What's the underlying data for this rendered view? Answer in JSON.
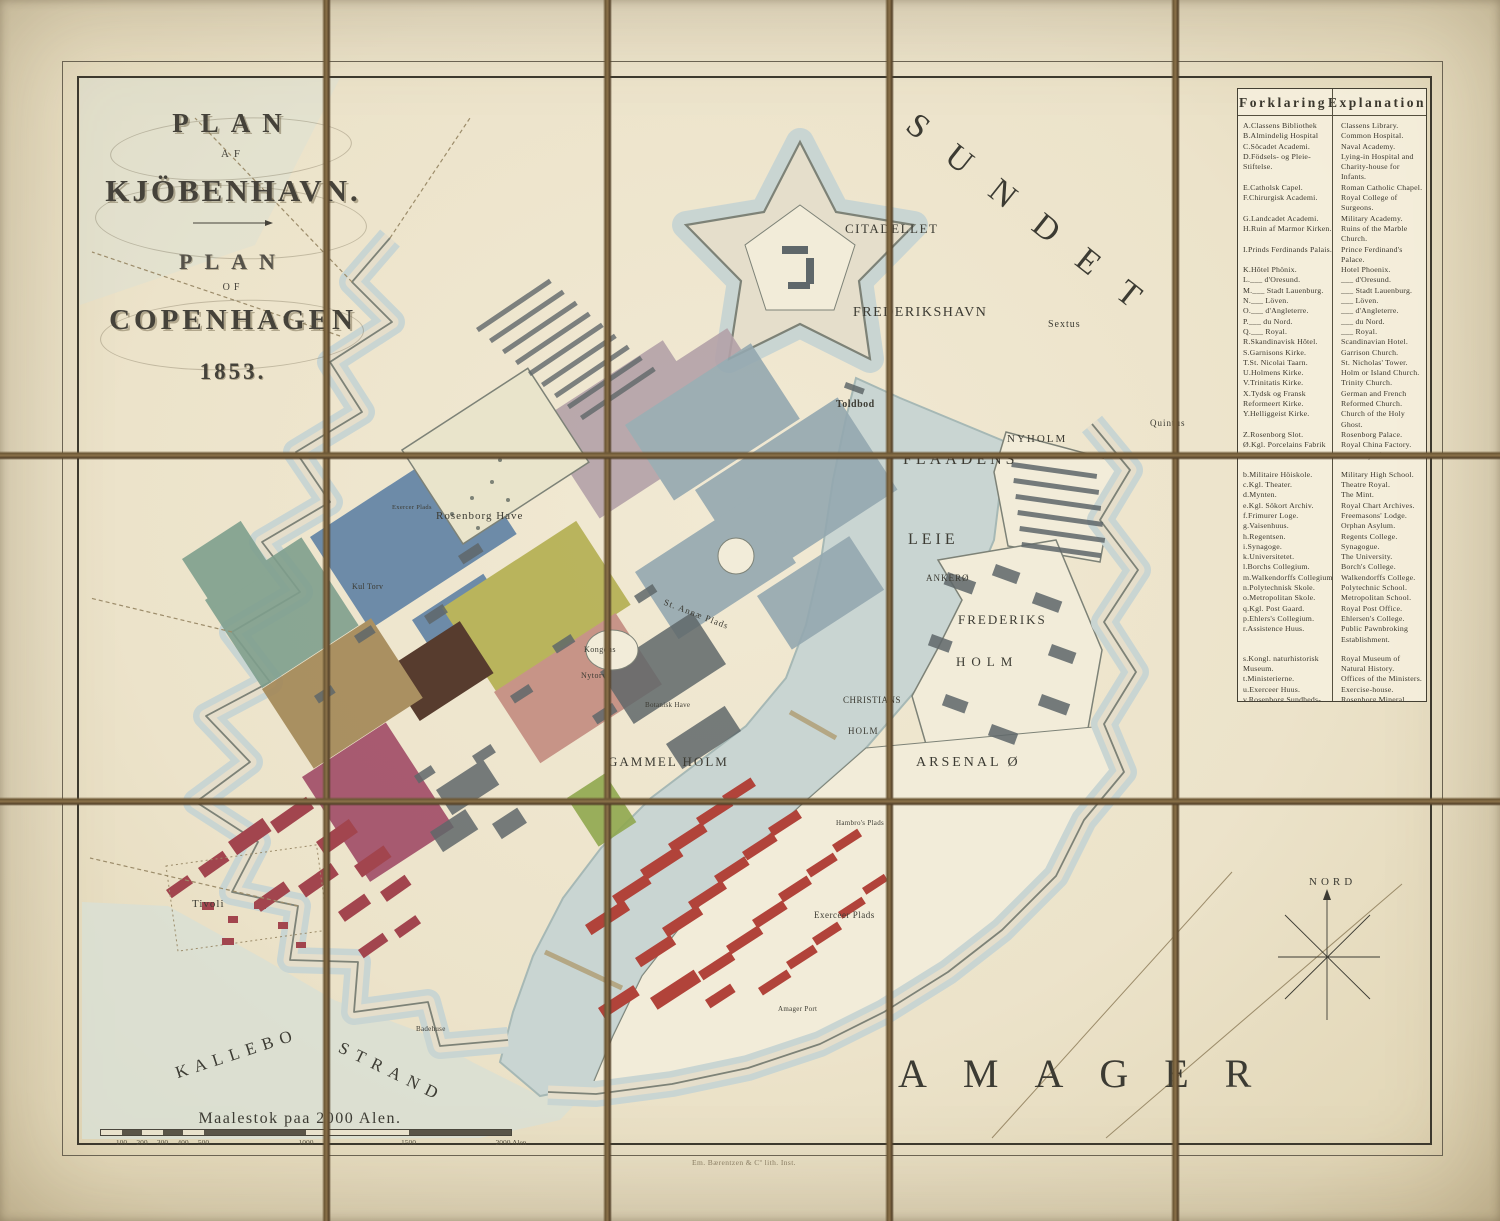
{
  "title_block": {
    "line1": "PLAN",
    "line2": "AF",
    "line3": "KJÖBENHAVN.",
    "line4": "PLAN",
    "line5": "OF",
    "line6": "COPENHAGEN",
    "year": "1853."
  },
  "legend": {
    "header_da": "Forklaring",
    "header_en": "Explanation",
    "entries": [
      {
        "da": "A.Classens Bibliothek",
        "en": "Classens Library."
      },
      {
        "da": "B.Almindelig Hospital",
        "en": "Common Hospital."
      },
      {
        "da": "C.Söcadet Academi.",
        "en": "Naval Academy."
      },
      {
        "da": "D.Födsels- og Pleie- Stiftelse.",
        "en": "Lying-in Hospital and Charity-house for Infants."
      },
      {
        "da": "E.Catholsk Capel.",
        "en": "Roman Catholic Chapel."
      },
      {
        "da": "F.Chirurgisk Academi.",
        "en": "Royal College of Surgeons."
      },
      {
        "da": "G.Landcadet Academi.",
        "en": "Military Academy."
      },
      {
        "da": "H.Ruin af Marmor Kirken.",
        "en": "Ruins of the Marble Church."
      },
      {
        "da": "I.Prinds Ferdinands Palais.",
        "en": "Prince Ferdinand's Palace."
      },
      {
        "da": "K.Hôtel Phönix.",
        "en": "Hotel Phoenix."
      },
      {
        "da": "L.___ d'Oresund.",
        "en": "___ d'Oresund."
      },
      {
        "da": "M.___ Stadt Lauenburg.",
        "en": "___ Stadt Lauenburg."
      },
      {
        "da": "N.___ Löven.",
        "en": "___ Löven."
      },
      {
        "da": "O.___ d'Angleterre.",
        "en": "___ d'Angleterre."
      },
      {
        "da": "P.___ du Nord.",
        "en": "___ du Nord."
      },
      {
        "da": "Q.___ Royal.",
        "en": "___ Royal."
      },
      {
        "da": "R.Skandinavisk Hôtel.",
        "en": "Scandinavian Hotel."
      },
      {
        "da": "S.Garnisons Kirke.",
        "en": "Garrison Church."
      },
      {
        "da": "T.St. Nicolai Taarn.",
        "en": "St. Nicholas' Tower."
      },
      {
        "da": "U.Holmens Kirke.",
        "en": "Holm or Island Church."
      },
      {
        "da": "V.Trinitatis Kirke.",
        "en": "Trinity Church."
      },
      {
        "da": "X.Tydsk og Fransk Reformeert Kirke.",
        "en": "German and French Reformed Church."
      },
      {
        "da": "Y.Helliggeist Kirke.",
        "en": "Church of the Holy Ghost."
      },
      {
        "da": "Z.Rosenborg Slot.",
        "en": "Rosenborg Palace."
      },
      {
        "da": "Ø.Kgl. Porcelains Fabrik",
        "en": "Royal China Factory."
      },
      {
        "da": "a.Kunst Academi.",
        "en": "Academy of Arts."
      },
      {
        "da": "b.Militaire Höiskole.",
        "en": "Military High School.",
        "gap": true
      },
      {
        "da": "c.Kgl. Theater.",
        "en": "Theatre Royal."
      },
      {
        "da": "d.Mynten.",
        "en": "The Mint."
      },
      {
        "da": "e.Kgl. Sökort Archiv.",
        "en": "Royal Chart Archives."
      },
      {
        "da": "f.Frimurer Loge.",
        "en": "Freemasons' Lodge."
      },
      {
        "da": "g.Vaisenhuus.",
        "en": "Orphan Asylum."
      },
      {
        "da": "h.Regentsen.",
        "en": "Regents College."
      },
      {
        "da": "i.Synagoge.",
        "en": "Synagogue."
      },
      {
        "da": "k.Universitetet.",
        "en": "The University."
      },
      {
        "da": "l.Borchs Collegium.",
        "en": "Borch's College."
      },
      {
        "da": "m.Walkendorffs Collegium",
        "en": "Walkendorffs College."
      },
      {
        "da": "n.Polytechnisk Skole.",
        "en": "Polytechnic School."
      },
      {
        "da": "o.Metropolitan Skole.",
        "en": "Metropolitan School."
      },
      {
        "da": "q.Kgl. Post Gaard.",
        "en": "Royal Post Office."
      },
      {
        "da": "p.Ehlers's Collegium.",
        "en": "Ehlersen's College."
      },
      {
        "da": "r.Assistence Huus.",
        "en": "Public Pawnbroking Establishment."
      },
      {
        "da": "s.Kongl. naturhistorisk Museum.",
        "en": "Royal Museum of Natural History.",
        "gap": true
      },
      {
        "da": "t.Ministerierne.",
        "en": "Offices of the Ministers."
      },
      {
        "da": "u.Exerceer Huus.",
        "en": "Exercise-house."
      },
      {
        "da": "v.Rosenborg Sundheds- brönd Anstalt.",
        "en": "Rosenborg Mineral Water Establishment."
      }
    ]
  },
  "map_labels": [
    {
      "id": "sundet",
      "text": "SUNDET",
      "x": 922,
      "y": 106,
      "size": 34,
      "ls": 31,
      "rot": 38.5
    },
    {
      "id": "citadellet",
      "text": "CITADELLET",
      "x": 845,
      "y": 221,
      "size": 13,
      "ls": 1.5
    },
    {
      "id": "frederikshavn",
      "text": "FREDERIKSHAVN",
      "x": 853,
      "y": 305,
      "size": 14,
      "ls": 1.5
    },
    {
      "id": "sextus",
      "text": "Sextus",
      "x": 1048,
      "y": 319,
      "size": 10,
      "ls": 1
    },
    {
      "id": "quintus",
      "text": "Quintus",
      "x": 1150,
      "y": 418,
      "size": 9,
      "ls": 1
    },
    {
      "id": "toldbod",
      "text": "Toldbod",
      "x": 836,
      "y": 399,
      "size": 10,
      "ls": 0.5,
      "bold": true
    },
    {
      "id": "nyholm",
      "text": "NYHOLM",
      "x": 1007,
      "y": 433,
      "size": 11,
      "ls": 2
    },
    {
      "id": "flaadens",
      "text": "FLAADENS",
      "x": 903,
      "y": 451,
      "size": 16,
      "ls": 4
    },
    {
      "id": "leie",
      "text": "LEIE",
      "x": 908,
      "y": 531,
      "size": 16,
      "ls": 4
    },
    {
      "id": "ankero",
      "text": "ANKERØ",
      "x": 926,
      "y": 573,
      "size": 9,
      "ls": 1
    },
    {
      "id": "frederiks",
      "text": "FREDERIKS",
      "x": 958,
      "y": 612,
      "size": 13,
      "ls": 2
    },
    {
      "id": "holm-frederiksholm",
      "text": "HOLM",
      "x": 956,
      "y": 654,
      "size": 13,
      "ls": 6
    },
    {
      "id": "christians",
      "text": "CHRISTIANS",
      "x": 843,
      "y": 695,
      "size": 9,
      "ls": 0.5
    },
    {
      "id": "holm-christiansholm",
      "text": "HOLM",
      "x": 848,
      "y": 726,
      "size": 9,
      "ls": 1
    },
    {
      "id": "gammel-holm",
      "text": "GAMMEL HOLM",
      "x": 608,
      "y": 754,
      "size": 13,
      "ls": 2
    },
    {
      "id": "arsenal-o",
      "text": "ARSENAL Ø",
      "x": 916,
      "y": 755,
      "size": 14,
      "ls": 3
    },
    {
      "id": "amager",
      "text": "AMAGER",
      "x": 898,
      "y": 1050,
      "size": 40,
      "ls": 36
    },
    {
      "id": "kallebo",
      "text": "KALLEBO",
      "x": 173,
      "y": 1064,
      "size": 17,
      "ls": 7,
      "rot": -18
    },
    {
      "id": "strand",
      "text": "STRAND",
      "x": 344,
      "y": 1038,
      "size": 17,
      "ls": 8,
      "rot": 26
    },
    {
      "id": "nord",
      "text": "NORD",
      "x": 1309,
      "y": 876,
      "size": 11,
      "ls": 4
    },
    {
      "id": "rosenborg-have",
      "text": "Rosenborg Have",
      "x": 436,
      "y": 510,
      "size": 11,
      "ls": 1
    },
    {
      "id": "exercer-plads-rosenborg",
      "text": "Exercer Plads",
      "x": 392,
      "y": 504,
      "size": 6.5,
      "ls": 0.3
    },
    {
      "id": "kul-torv",
      "text": "Kul Torv",
      "x": 352,
      "y": 582,
      "size": 8,
      "ls": 0.3
    },
    {
      "id": "tivoli",
      "text": "Tivoli",
      "x": 192,
      "y": 898,
      "size": 11,
      "ls": 1
    },
    {
      "id": "exerceer-plads",
      "text": "Exerceer Plads",
      "x": 814,
      "y": 910,
      "size": 9,
      "ls": 0.5
    },
    {
      "id": "hambros-plads",
      "text": "Hambro's Plads",
      "x": 836,
      "y": 819,
      "size": 7,
      "ls": 0.3
    },
    {
      "id": "botanisk-have",
      "text": "Botanisk Have",
      "x": 645,
      "y": 701,
      "size": 7,
      "ls": 0.3
    },
    {
      "id": "kongens",
      "text": "Kongens",
      "x": 584,
      "y": 645,
      "size": 8,
      "ls": 0.5
    },
    {
      "id": "nytorv",
      "text": "Nytorv",
      "x": 581,
      "y": 671,
      "size": 8,
      "ls": 0.5
    },
    {
      "id": "st-annae-plads",
      "text": "St. Annæ Plads",
      "x": 666,
      "y": 597,
      "size": 9,
      "ls": 1,
      "rot": 21
    },
    {
      "id": "badehuse",
      "text": "Badehuse",
      "x": 416,
      "y": 1025,
      "size": 7,
      "ls": 0.3
    },
    {
      "id": "amager-port",
      "text": "Amager Port",
      "x": 778,
      "y": 1005,
      "size": 7,
      "ls": 0.3
    }
  ],
  "scale": {
    "title": "Maalestok paa 2000 Alen.",
    "ticks": [
      {
        "label": "100",
        "frac": 0.05
      },
      {
        "label": "200",
        "frac": 0.1
      },
      {
        "label": "300",
        "frac": 0.15
      },
      {
        "label": "400",
        "frac": 0.2
      },
      {
        "label": "500",
        "frac": 0.25
      },
      {
        "label": "1000",
        "frac": 0.5
      },
      {
        "label": "1500",
        "frac": 0.75
      },
      {
        "label": "2000 Alen",
        "frac": 1.0
      }
    ]
  },
  "imprint": "Em. Bærentzen & Cº lith. Inst.",
  "compass": {
    "label": "NORD"
  },
  "colors": {
    "paper": "#ece4cd",
    "paper_light": "#f2ecd9",
    "ink": "#3c3b33",
    "water": "#c9d5d2",
    "water_edge": "#a6b8b5",
    "water_pale": "#d9dfd4",
    "rampart": "#e5decb",
    "rampart_line": "#7d8277",
    "fold": "#76603f",
    "slate": "#93a7af",
    "mauve": "#b3a1a8",
    "blue": "#5e81a4",
    "olive": "#b3ae50",
    "brown": "#46291c",
    "tan": "#a28655",
    "pink": "#c28b7f",
    "crimson": "#a04a66",
    "teal": "#7e9f8d",
    "green": "#8fa84f",
    "red": "#b1433a",
    "maroon": "#a2454e",
    "building": "#5f676a",
    "garden": "#e9e4cb",
    "road": "#9c8c6a",
    "bridge": "#b4a784"
  }
}
